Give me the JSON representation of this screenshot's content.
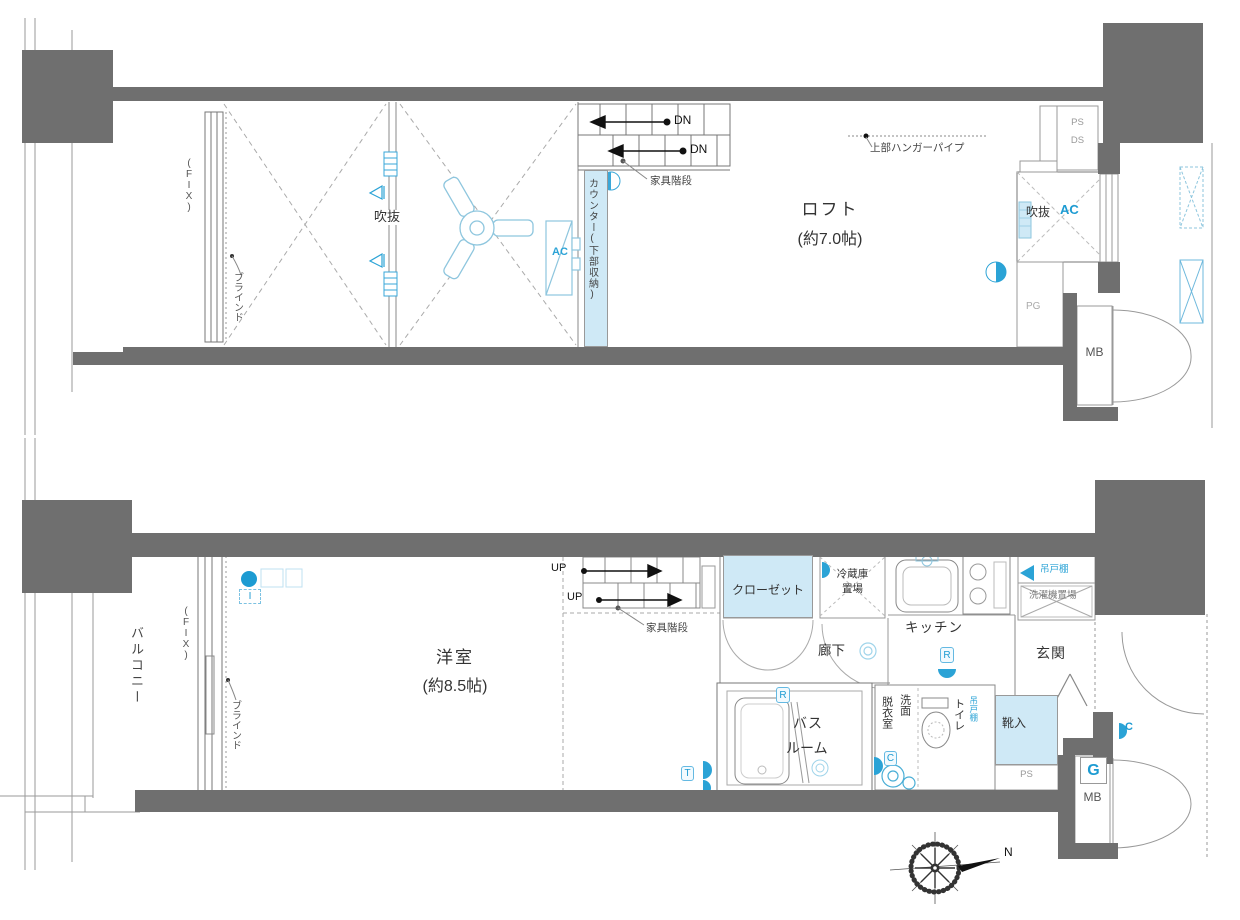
{
  "colors": {
    "wall": "#6f6f6f",
    "accent": "#1d9bd2",
    "light_fill": "#cfe9f6",
    "line": "#999999"
  },
  "upper_plan": {
    "fix_window": "(FIX)",
    "blind": "ブラインド",
    "void_main": "吹抜",
    "counter_storage": "カウンター(下部収納)",
    "ac_unit": "AC",
    "stairs": {
      "dn1": "DN",
      "dn2": "DN",
      "caption": "家具階段"
    },
    "loft_name": "ロフト",
    "loft_size": "(約7.0帖)",
    "hanger_pipe": "上部ハンガーパイプ",
    "ps": "PS",
    "ds": "DS",
    "void_box": {
      "name": "吹抜",
      "ac": "AC"
    },
    "pg": "PG",
    "mb": "MB"
  },
  "lower_plan": {
    "balcony": "バルコニー",
    "fix_window": "(FIX)",
    "blind": "ブラインド",
    "ac_mark": "I",
    "room_name": "洋室",
    "room_size": "(約8.5帖)",
    "stairs": {
      "up1": "UP",
      "up2": "UP",
      "caption": "家具階段"
    },
    "closet": "クローゼット",
    "fridge": {
      "line1": "冷蔵庫",
      "line2": "置場"
    },
    "kitchen": "キッチン",
    "hallway": "廊下",
    "laundry": {
      "shelf": "吊戸棚",
      "space": "洗濯機置場"
    },
    "entrance": "玄関",
    "shoe_cabinet": "靴入",
    "ps": "PS",
    "bathroom": {
      "line1": "バス",
      "line2": "ルーム"
    },
    "washroom": {
      "col_right": "洗面",
      "col_left": "脱衣室"
    },
    "toilet": "トイレ",
    "toilet_shelf": "吊戸棚",
    "badges": {
      "bath_r": "R",
      "kitchen_r": "R",
      "wash_c": "C",
      "bath_t": "T",
      "corridor_c": "C",
      "meter_g": "G"
    },
    "mb": "MB",
    "compass_north": "N"
  }
}
